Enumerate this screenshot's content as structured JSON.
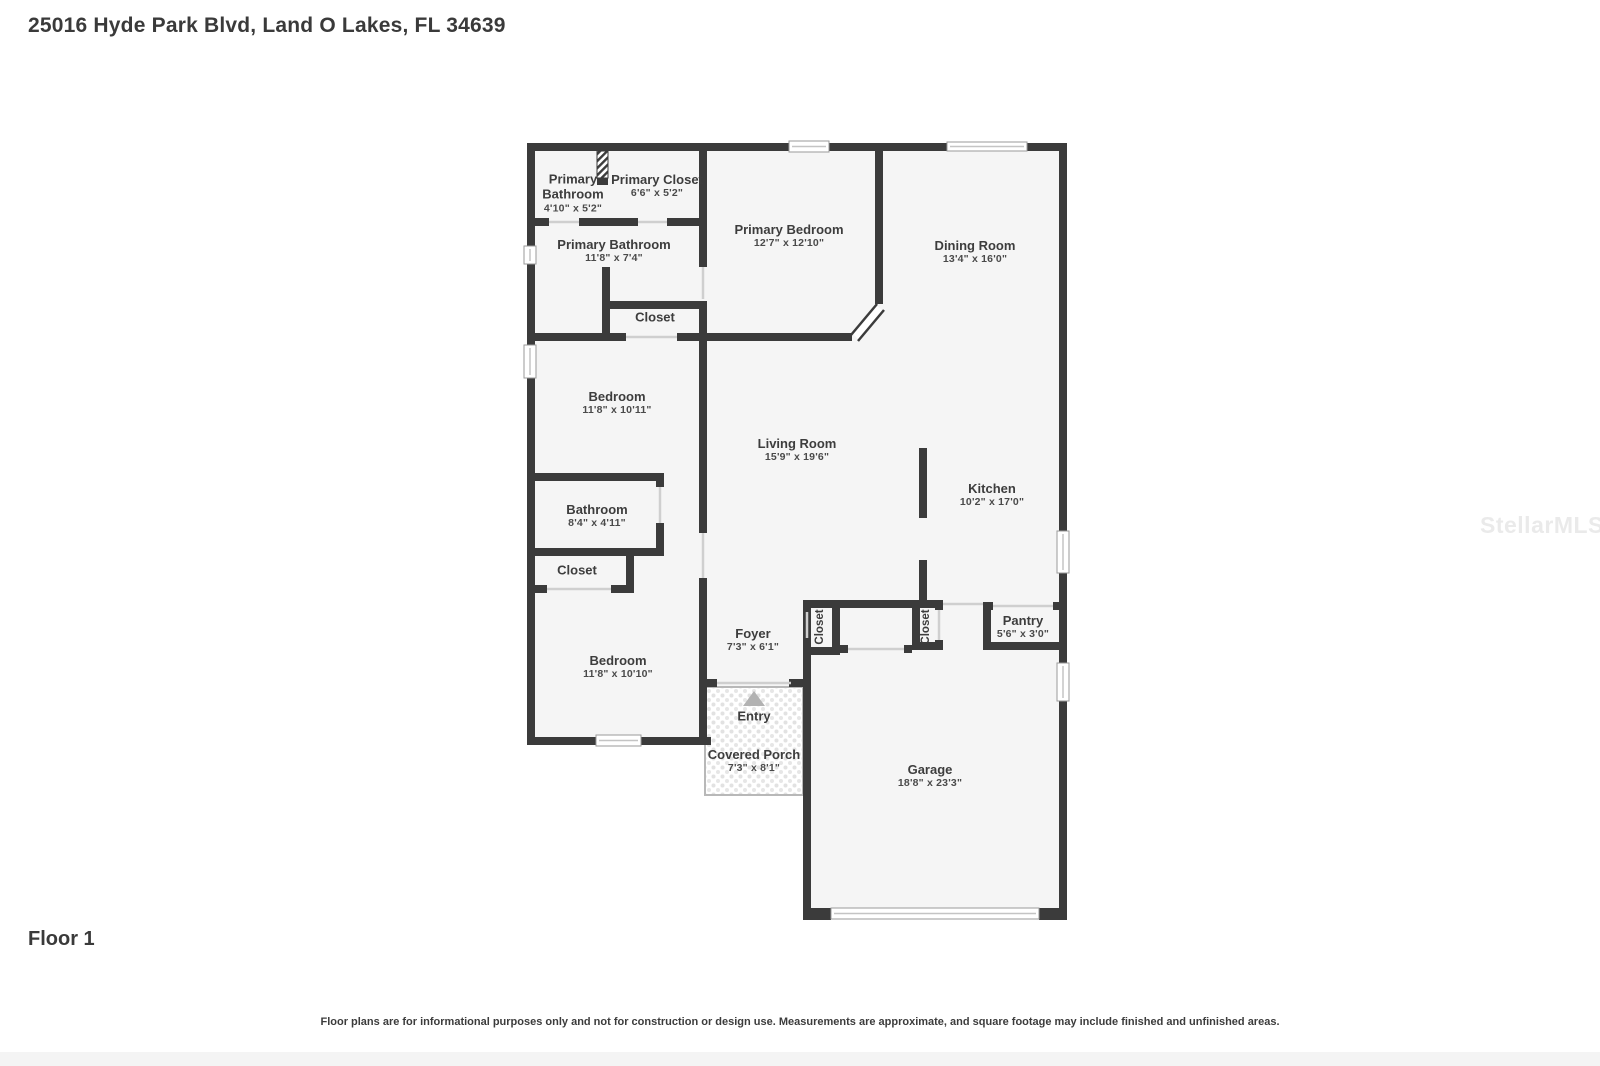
{
  "page": {
    "title": "25016 Hyde Park Blvd, Land O Lakes, FL 34639",
    "floor_label": "Floor 1",
    "disclaimer": "Floor plans are for informational purposes only and not for construction or design use. Measurements are approximate, and square footage may include finished and unfinished areas.",
    "watermark": "StellarMLS"
  },
  "colors": {
    "wall": "#3b3b3b",
    "floor": "#f5f5f5",
    "opening": "#cfcfcf",
    "window_frame": "#9a9a9a",
    "porch_border": "#b8b8b8",
    "entry_arrow": "#b2b2b2",
    "text": "#3d3d3d"
  },
  "rooms": [
    {
      "id": "primary-bathroom-upper",
      "name": "Primary Bathroom",
      "dims": "4'10\" x 5'2\"",
      "x": 573,
      "y": 193,
      "narrow": true
    },
    {
      "id": "primary-closet",
      "name": "Primary Closet",
      "dims": "6'6\" x 5'2\"",
      "x": 657,
      "y": 186
    },
    {
      "id": "primary-bedroom",
      "name": "Primary Bedroom",
      "dims": "12'7\" x 12'10\"",
      "x": 789,
      "y": 236
    },
    {
      "id": "dining-room",
      "name": "Dining Room",
      "dims": "13'4\" x 16'0\"",
      "x": 975,
      "y": 252
    },
    {
      "id": "primary-bathroom",
      "name": "Primary Bathroom",
      "dims": "11'8\" x 7'4\"",
      "x": 614,
      "y": 251
    },
    {
      "id": "closet-primary",
      "name": "Closet",
      "dims": "",
      "x": 655,
      "y": 317
    },
    {
      "id": "bedroom-1",
      "name": "Bedroom",
      "dims": "11'8\" x 10'11\"",
      "x": 617,
      "y": 403
    },
    {
      "id": "living-room",
      "name": "Living Room",
      "dims": "15'9\" x 19'6\"",
      "x": 797,
      "y": 450
    },
    {
      "id": "kitchen",
      "name": "Kitchen",
      "dims": "10'2\" x 17'0\"",
      "x": 992,
      "y": 495
    },
    {
      "id": "bathroom",
      "name": "Bathroom",
      "dims": "8'4\" x 4'11\"",
      "x": 597,
      "y": 516
    },
    {
      "id": "closet-hall",
      "name": "Closet",
      "dims": "",
      "x": 577,
      "y": 570
    },
    {
      "id": "bedroom-2",
      "name": "Bedroom",
      "dims": "11'8\" x 10'10\"",
      "x": 618,
      "y": 667
    },
    {
      "id": "foyer",
      "name": "Foyer",
      "dims": "7'3\" x 6'1\"",
      "x": 753,
      "y": 640
    },
    {
      "id": "closet-foyer",
      "name": "Closet",
      "dims": "",
      "x": 821,
      "y": 627,
      "rotate": true,
      "small": true
    },
    {
      "id": "closet-kitchen",
      "name": "Closet",
      "dims": "",
      "x": 927,
      "y": 627,
      "rotate": true,
      "small": true
    },
    {
      "id": "pantry",
      "name": "Pantry",
      "dims": "5'6\" x 3'0\"",
      "x": 1023,
      "y": 627
    },
    {
      "id": "entry",
      "name": "Entry",
      "dims": "",
      "x": 754,
      "y": 716
    },
    {
      "id": "covered-porch",
      "name": "Covered Porch",
      "dims": "7'3\" x 8'1\"",
      "x": 754,
      "y": 761
    },
    {
      "id": "garage",
      "name": "Garage",
      "dims": "18'8\" x 23'3\"",
      "x": 930,
      "y": 776
    }
  ]
}
